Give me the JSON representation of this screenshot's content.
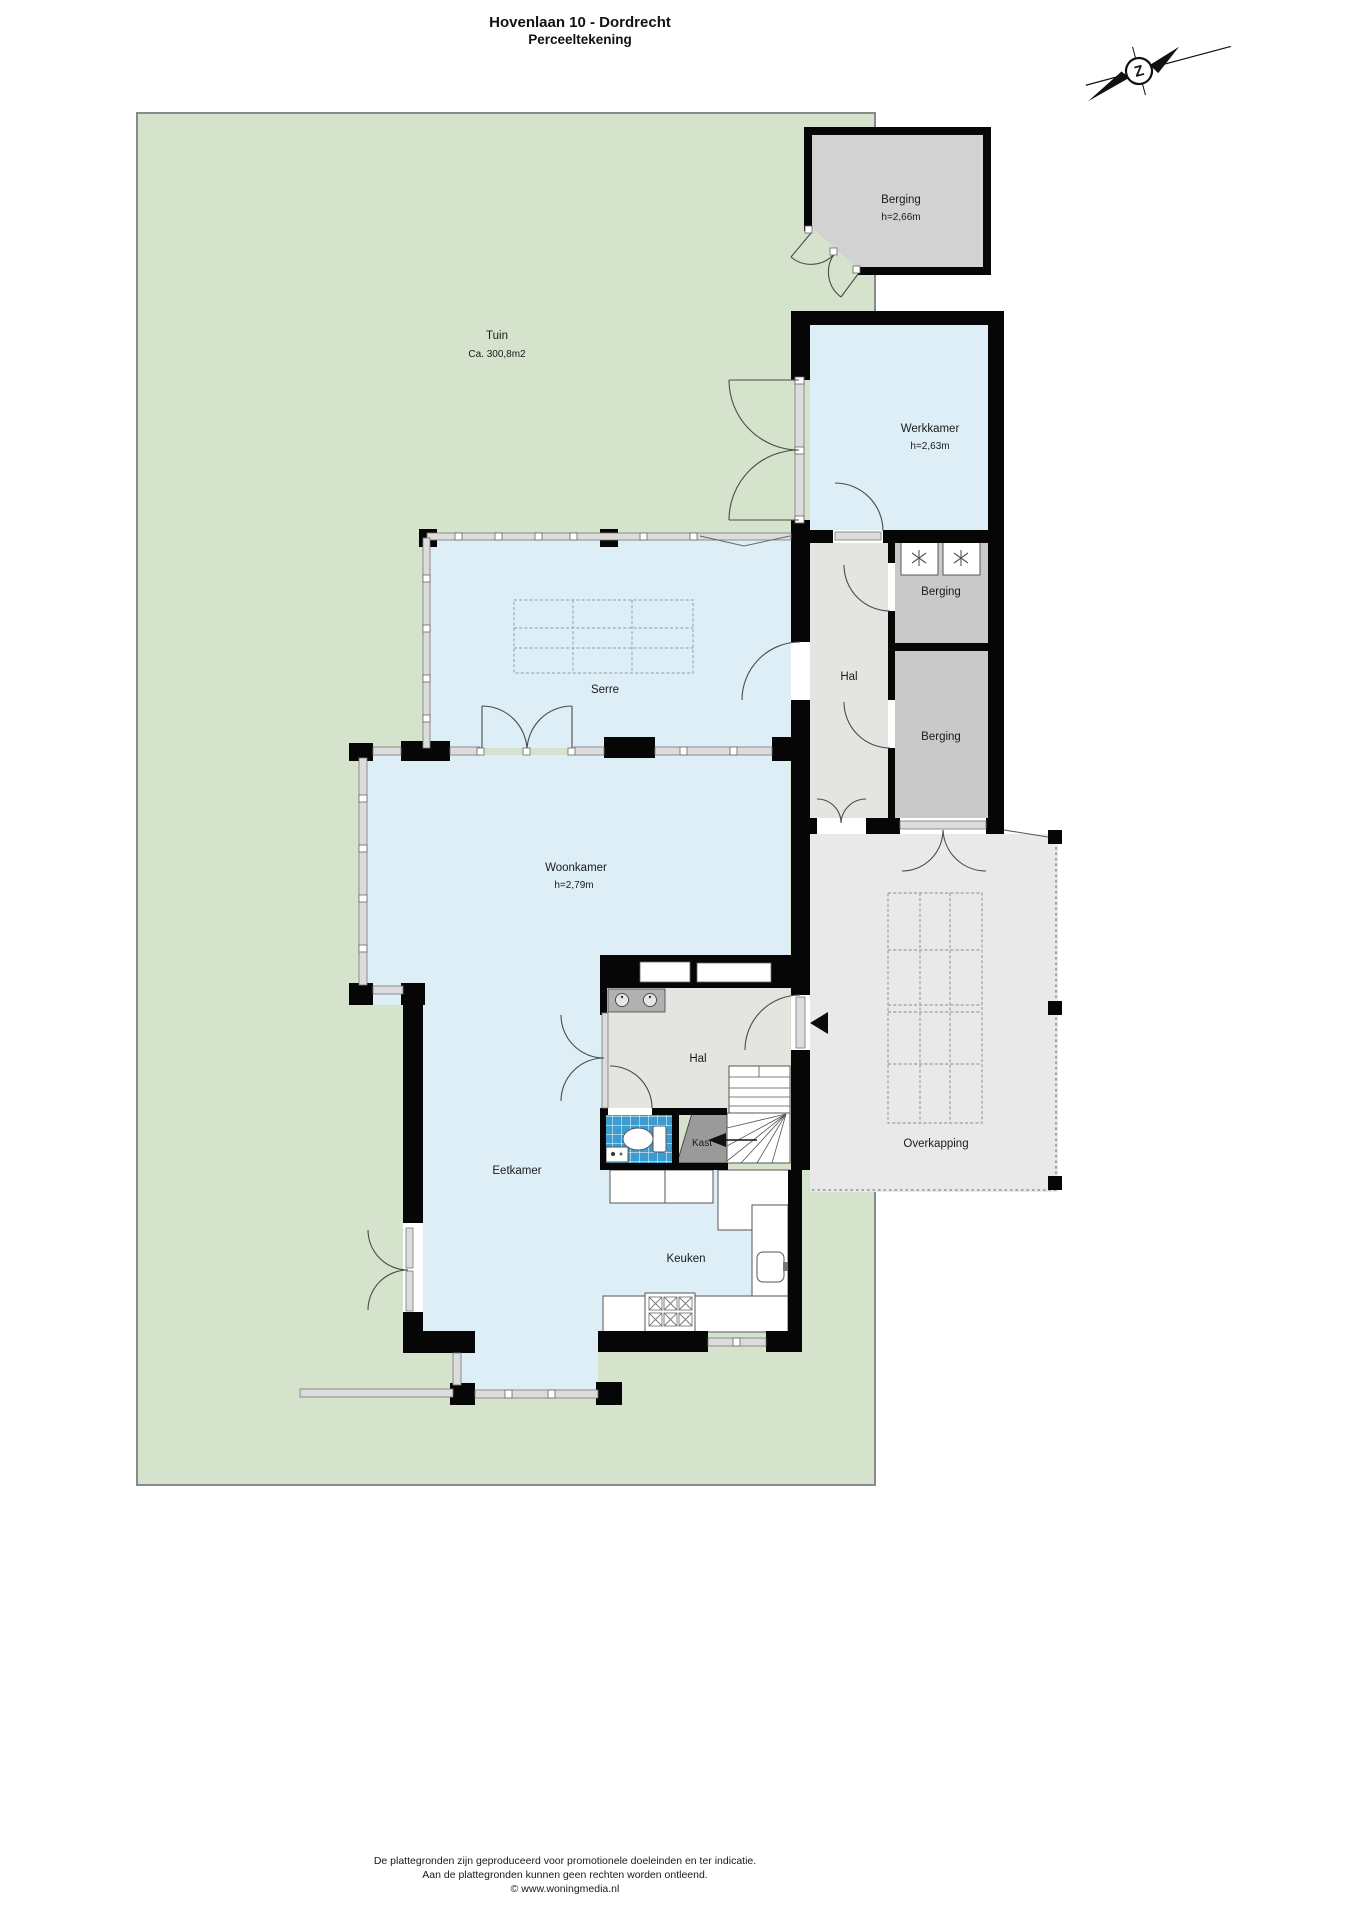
{
  "header": {
    "title": "Hovenlaan 10 - Dordrecht",
    "subtitle": "Perceeltekening"
  },
  "compass": {
    "letter": "Z"
  },
  "garden": {
    "label": "Tuin",
    "area": "Ca. 300,8m2"
  },
  "rooms": {
    "shed_berging": {
      "label": "Berging",
      "height": "h=2,66m"
    },
    "werkkamer": {
      "label": "Werkkamer",
      "height": "h=2,63m"
    },
    "hal_boven": {
      "label": "Hal"
    },
    "berging_1": {
      "label": "Berging"
    },
    "berging_2": {
      "label": "Berging"
    },
    "serre": {
      "label": "Serre"
    },
    "woonkamer": {
      "label": "Woonkamer",
      "height": "h=2,79m"
    },
    "hal_beneden": {
      "label": "Hal"
    },
    "kast": {
      "label": "Kast"
    },
    "eetkamer": {
      "label": "Eetkamer"
    },
    "keuken": {
      "label": "Keuken"
    },
    "overkapping": {
      "label": "Overkapping"
    }
  },
  "footer": {
    "line1": "De plattegronden zijn geproduceerd voor promotionele doeleinden en ter indicatie.",
    "line2": "Aan de plattegronden kunnen geen rechten worden ontleend.",
    "line3": "© www.woningmedia.nl"
  },
  "colors": {
    "garden": "#d5e3cc",
    "room_blue": "#ddeef7",
    "hall_gray": "#e4e4e1",
    "storage_gray": "#c9c9c9",
    "shed_gray": "#d2d2d2",
    "canopy_gray": "#e9e9e9",
    "toilet_blue": "#3d9ccf",
    "wall": "#060606"
  }
}
